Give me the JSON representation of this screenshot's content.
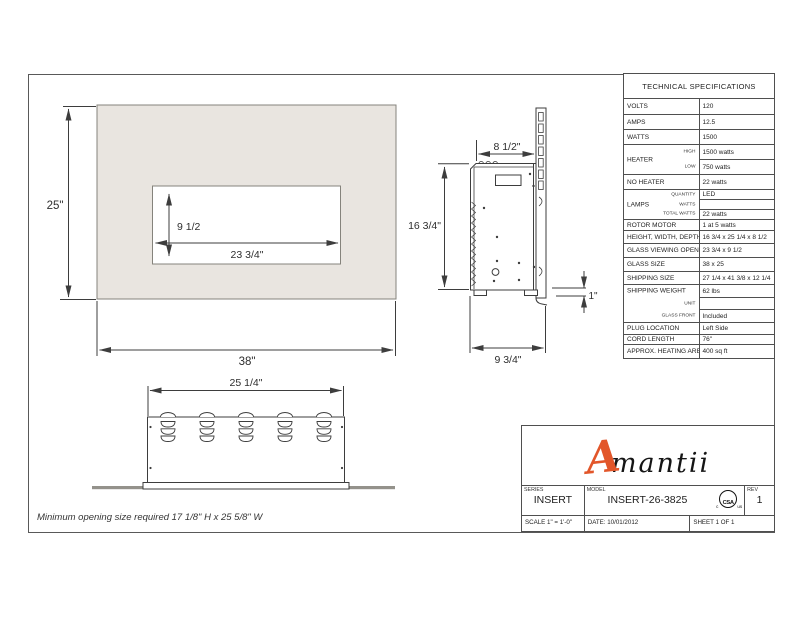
{
  "sheet": {
    "note": "Minimum opening size required 17 1/8\" H x 25 5/8\" W"
  },
  "dims": {
    "front_height": "25\"",
    "front_width": "38\"",
    "opening_height": "9 1/2",
    "opening_width": "23 3/4\"",
    "side_depth_top": "8 1/2\"",
    "side_height": "16 3/4\"",
    "side_trim": "1\"",
    "side_depth_bottom": "9 3/4\"",
    "bottom_width": "25 1/4\""
  },
  "specs": {
    "title": "TECHNICAL SPECIFICATIONS",
    "volts": {
      "label": "VOLTS",
      "value": "120"
    },
    "amps": {
      "label": "AMPS",
      "value": "12.5"
    },
    "watts": {
      "label": "WATTS",
      "value": "1500"
    },
    "heater": {
      "label": "HEATER",
      "high_label": "HIGH",
      "high_value": "1500 watts",
      "low_label": "LOW",
      "low_value": "750 watts"
    },
    "no_heater": {
      "label": "NO HEATER",
      "value": "22 watts"
    },
    "lamps": {
      "label": "LAMPS",
      "quantity_label": "QUANTITY",
      "quantity_value": "LED",
      "watts_label": "WATTS",
      "watts_value": "",
      "total_label": "TOTAL WATTS",
      "total_value": "22 watts"
    },
    "rotor": {
      "label": "ROTOR MOTOR",
      "value": "1 at 5 watts"
    },
    "hwd": {
      "label": "HEIGHT, WIDTH, DEPTH",
      "value": "16 3/4 x 25 1/4 x 8 1/2"
    },
    "viewing": {
      "label": "GLASS VIEWING OPENING",
      "value": "23 3/4 x 9 1/2"
    },
    "glass": {
      "label": "GLASS SIZE",
      "value": "38 x 25"
    },
    "ship_size": {
      "label": "SHIPPING SIZE",
      "value": "27 1/4 x 41 3/8 x 12 1/4"
    },
    "ship_weight": {
      "label": "SHIPPING WEIGHT",
      "value": "62 lbs",
      "unit_label": "UNIT",
      "unit_value": "",
      "front_label": "GLASS FRONT",
      "front_value": "Included"
    },
    "plug": {
      "label": "PLUG LOCATION",
      "value": "Left Side"
    },
    "cord": {
      "label": "CORD LENGTH",
      "value": "76\""
    },
    "area": {
      "label": "APPROX. HEATING AREA",
      "value": "400 sq ft"
    }
  },
  "title_block": {
    "brand_a": "A",
    "brand_rest": "mantii",
    "series_label": "SERIES",
    "series_value": "INSERT",
    "model_label": "MODEL",
    "model_value": "INSERT-26-3825",
    "rev_label": "REV",
    "rev_value": "1",
    "scale": "SCALE 1\" = 1'-0\"",
    "date": "DATE: 10/01/2012",
    "sheet": "SHEET 1 OF 1",
    "csa": "CSA",
    "csa_c": "c",
    "csa_us": "us"
  },
  "colors": {
    "face_fill": "#e9e5e0",
    "brand_orange": "#e2562a",
    "line": "#3d3d3d"
  }
}
